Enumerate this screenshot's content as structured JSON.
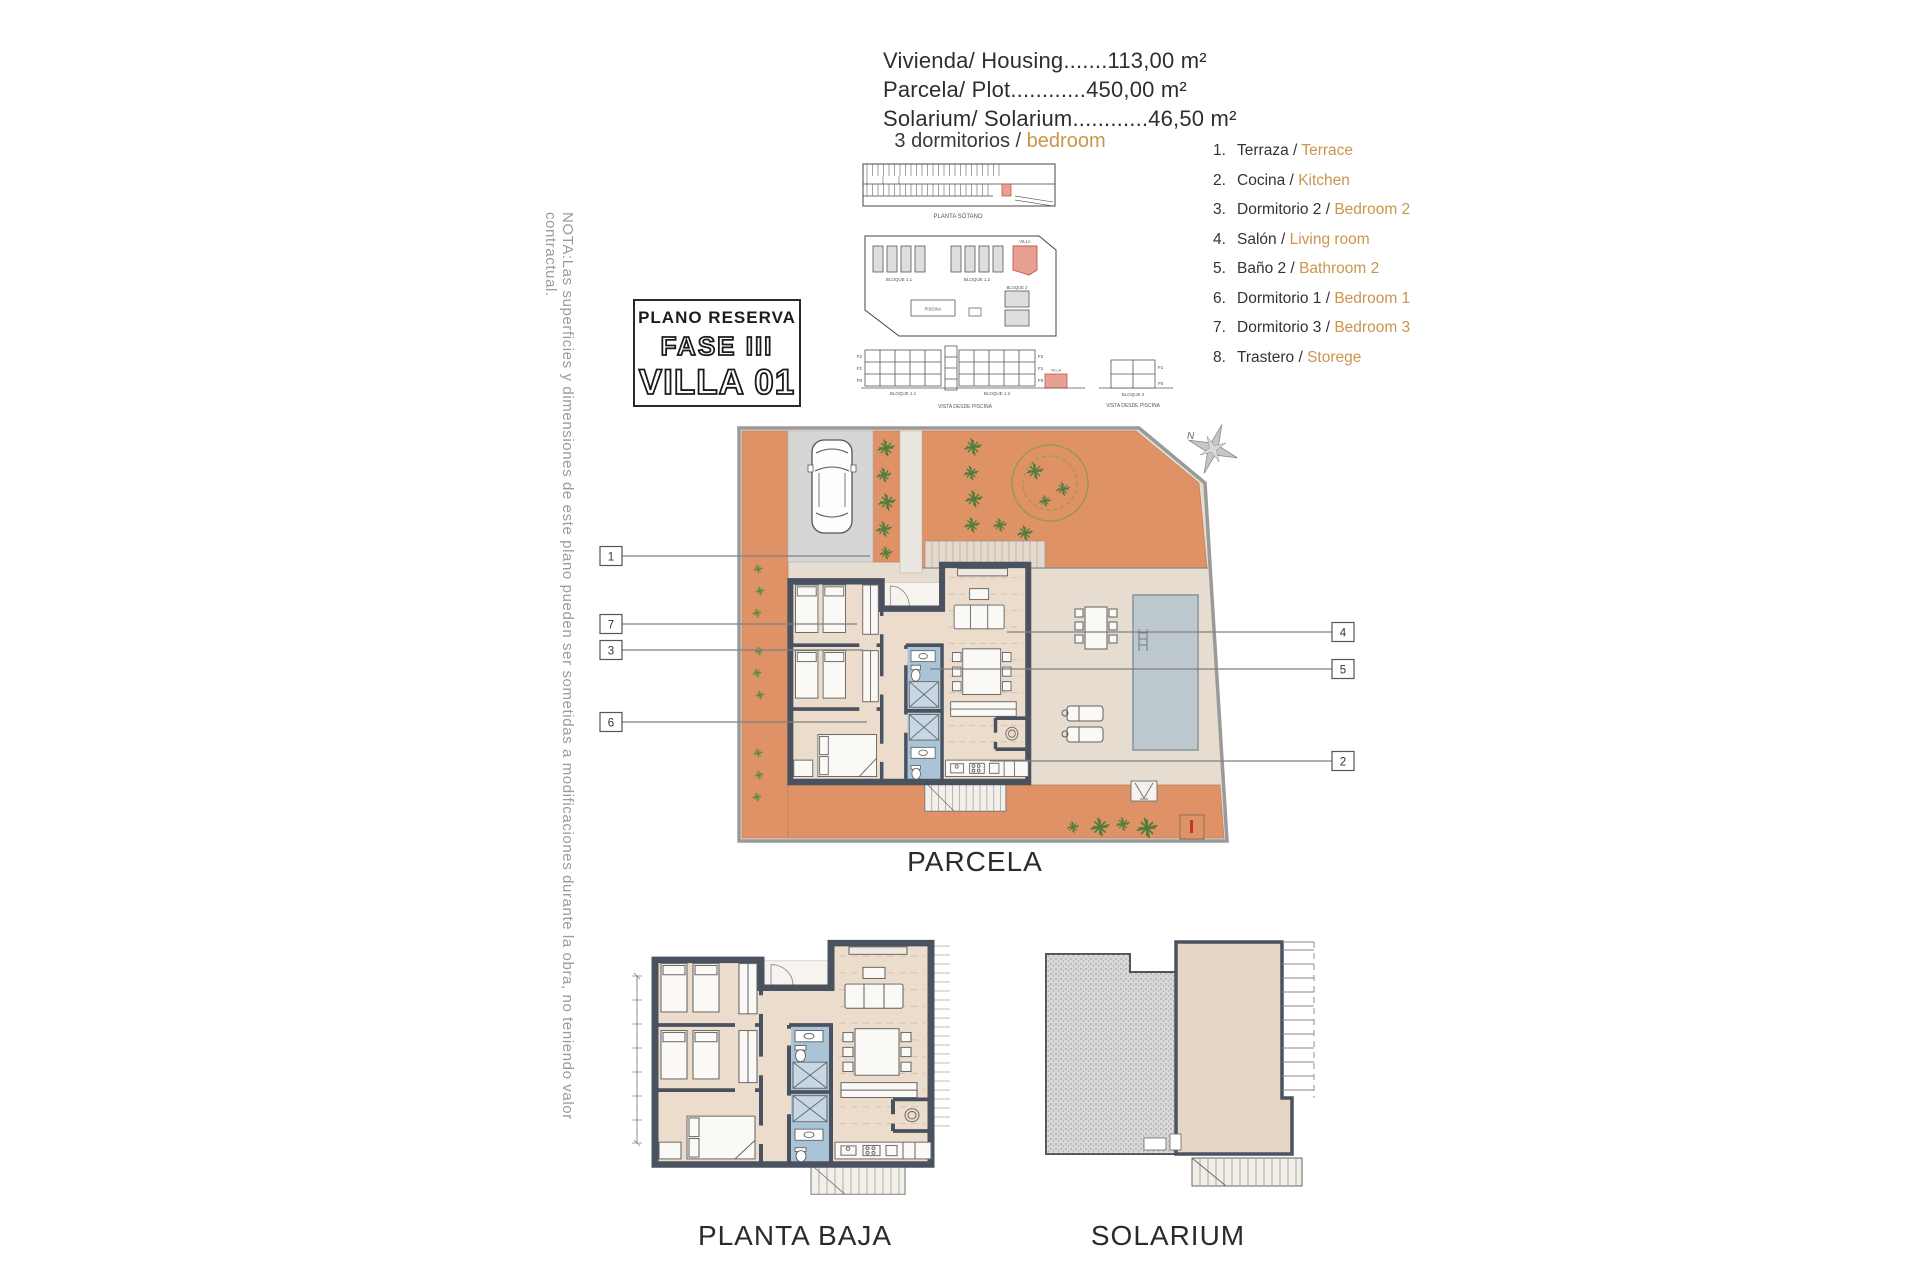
{
  "colors": {
    "ground_orange": "#df9266",
    "terrace_beige": "#e6dcd0",
    "floor_beige": "#ecdccb",
    "wall_dark": "#4a5260",
    "bath_blue": "#a9c4d6",
    "pool_gray": "#bec8cf",
    "villa_red_fill": "#e9a094",
    "villa_red_stroke": "#c2544a",
    "block_gray": "#dedede",
    "accent_orange_text": "#c9964a",
    "tree_green": "#4e7d3c",
    "note_gray": "#9b9b9b"
  },
  "header": {
    "line1": "Vivienda/ Housing.......113,00 m²",
    "line2": "Parcela/ Plot............450,00 m²",
    "line3": "Solarium/ Solarium............46,50 m²"
  },
  "bedrooms_label": {
    "es": "3 dormitorios /",
    "en": "bedroom"
  },
  "title_box": {
    "subtitle": "PLANO RESERVA",
    "phase": "FASE III",
    "villa": "VILLA 01"
  },
  "site_overview": {
    "basement_caption": "PLANTA SÓTANO",
    "blocks": {
      "bloque11": "BLOQUE 1.1",
      "bloque12": "BLOQUE 1.2",
      "bloque2": "BLOQUE 2",
      "villa": "VILLA",
      "piscina": "PISCINA"
    },
    "elevations": {
      "bloque11": "BLOQUE 1.1",
      "bloque12": "BLOQUE 1.2",
      "bloque2": "BLOQUE 2",
      "villa_marker": "VILLA",
      "caption_left": "VISTA DESDE PISCINA",
      "caption_right": "VISTA DESDE PISCINA",
      "floors_left": [
        "F2",
        "F1",
        "F0"
      ],
      "floors_right": [
        "F2",
        "F1",
        "F0"
      ],
      "floors_b2": [
        "F1",
        "F0"
      ]
    }
  },
  "legend": {
    "items": [
      {
        "num": "1.",
        "es": "Terraza /",
        "en": "Terrace"
      },
      {
        "num": "2.",
        "es": "Cocina /",
        "en": "Kitchen"
      },
      {
        "num": "3.",
        "es": "Dormitorio 2 /",
        "en": "Bedroom 2"
      },
      {
        "num": "4.",
        "es": "Salón /",
        "en": "Living room"
      },
      {
        "num": "5.",
        "es": "Baño 2 /",
        "en": "Bathroom 2"
      },
      {
        "num": "6.",
        "es": "Dormitorio 1 /",
        "en": "Bedroom 1"
      },
      {
        "num": "7.",
        "es": "Dormitorio 3 /",
        "en": "Bedroom 3"
      },
      {
        "num": "8.",
        "es": "Trastero /",
        "en": "Storege"
      }
    ]
  },
  "parcela": {
    "label": "PARCELA",
    "compass_n": "N",
    "callouts_left": [
      "1",
      "7",
      "3",
      "6"
    ],
    "callouts_right": [
      "4",
      "5",
      "2"
    ]
  },
  "planta_baja": {
    "label": "PLANTA BAJA"
  },
  "solarium": {
    "label": "SOLARIUM"
  },
  "note": "NOTA:Las superficies y dimensiones de este plano pueden ser sometidas a modificaciones durante la obra, no teniendo valor contractual."
}
